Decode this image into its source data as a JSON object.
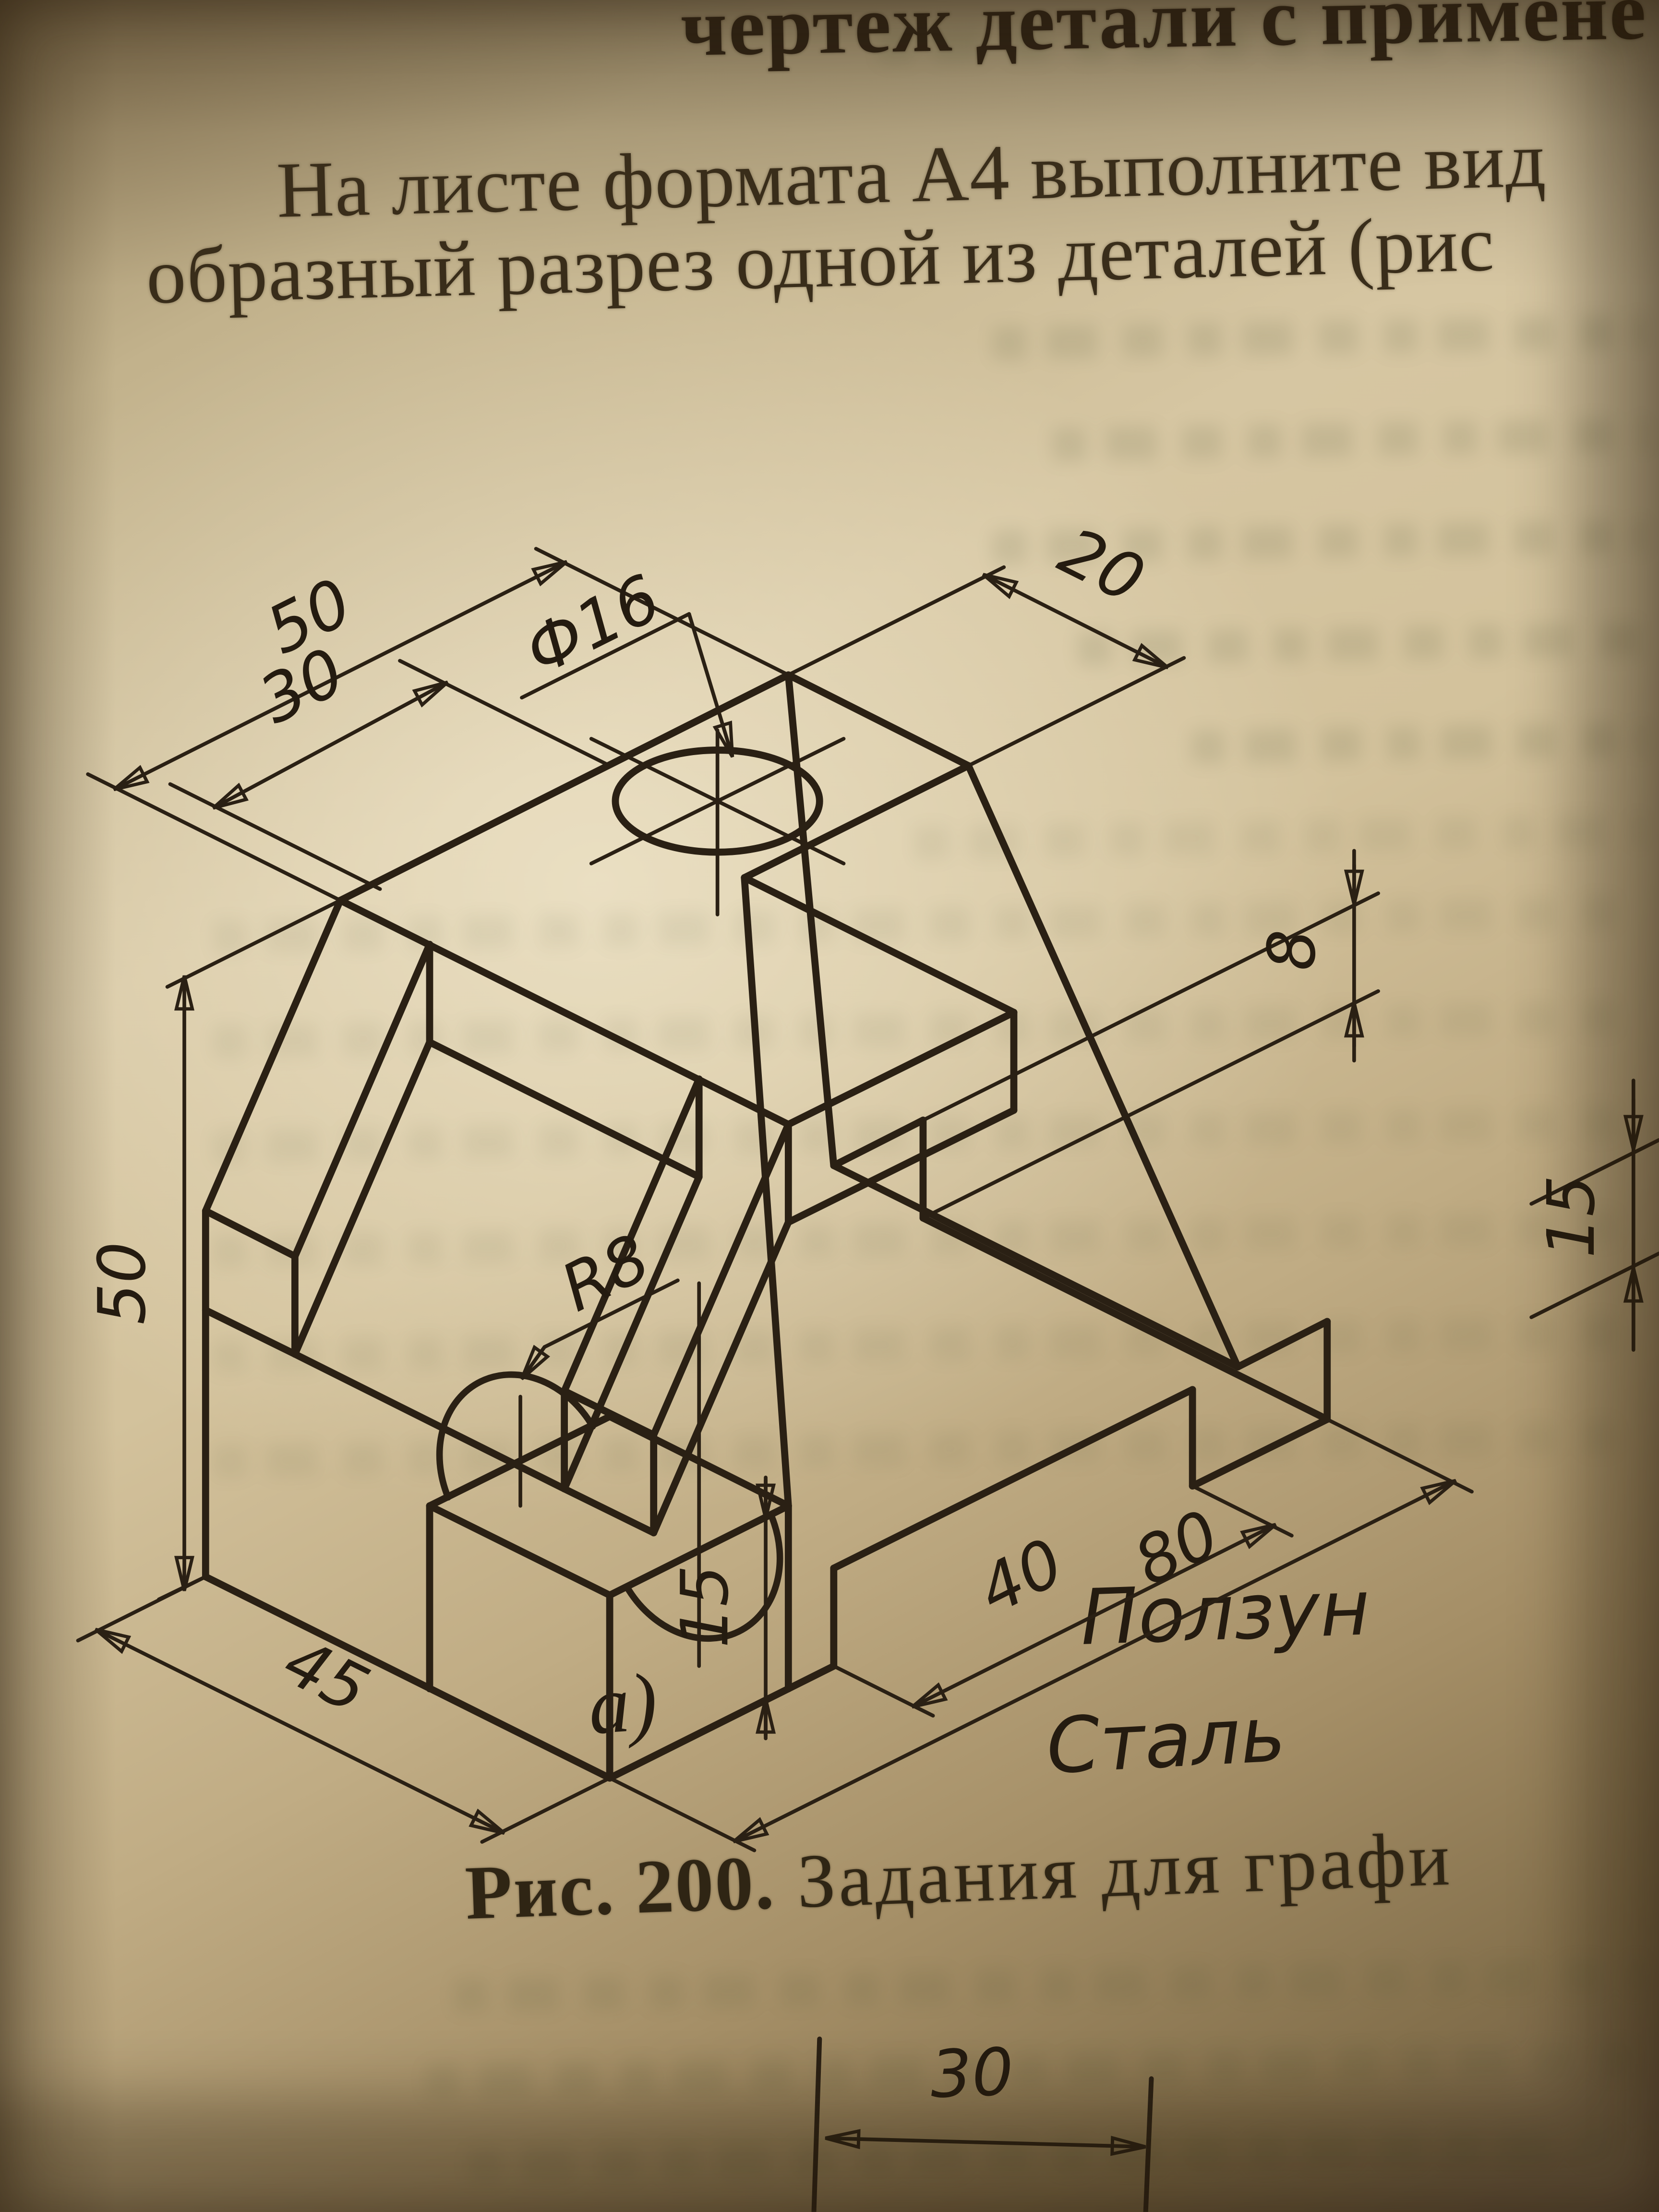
{
  "page": {
    "header_fragment": "чертеж детали с примене",
    "intro_line1": "На листе формата А4 выполните вид",
    "intro_line2": "образный разрез одной из деталей (рис",
    "caption_prefix": "Рис. 200.",
    "caption_text": " Задания для графи"
  },
  "figure": {
    "variant_label": "а)",
    "part_name": "Ползун",
    "material": "Сталь"
  },
  "dimensions": {
    "top_width": "50",
    "groove_width": "30",
    "top_right_width": "20",
    "hole_diameter": "Ф16",
    "height": "50",
    "notch_radius": "R8",
    "slab_height": "15",
    "base_depth": "45",
    "recess_length": "40",
    "overall_length": "80",
    "step_height": "8",
    "adjacent_figure_dim": "15",
    "next_figure_dim": "30"
  },
  "colors": {
    "ink": "#2a2014",
    "paper_light": "#d6c6a2",
    "paper_dark": "#695741"
  }
}
